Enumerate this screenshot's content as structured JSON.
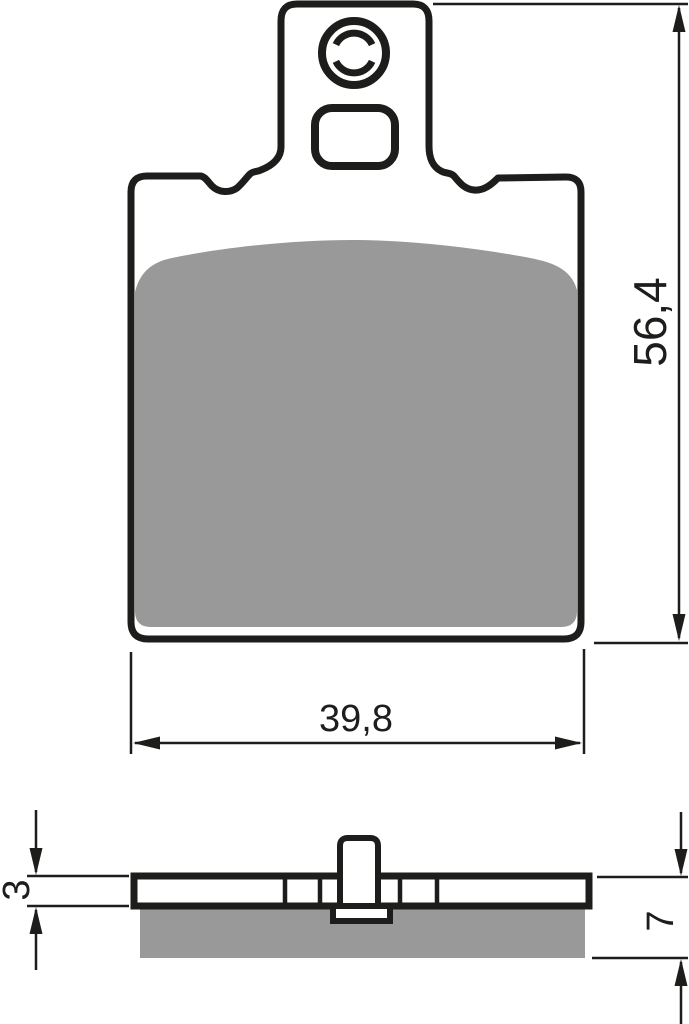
{
  "drawing": {
    "subject": "brake-pad-technical-drawing",
    "colors": {
      "line": "#1d1d1b",
      "friction_material": "#999999",
      "background": "#ffffff"
    },
    "front_view": {
      "height_label": "56,4",
      "width_label": "39,8"
    },
    "side_view": {
      "backplate_thickness_label": "3",
      "total_thickness_label": "7"
    }
  }
}
